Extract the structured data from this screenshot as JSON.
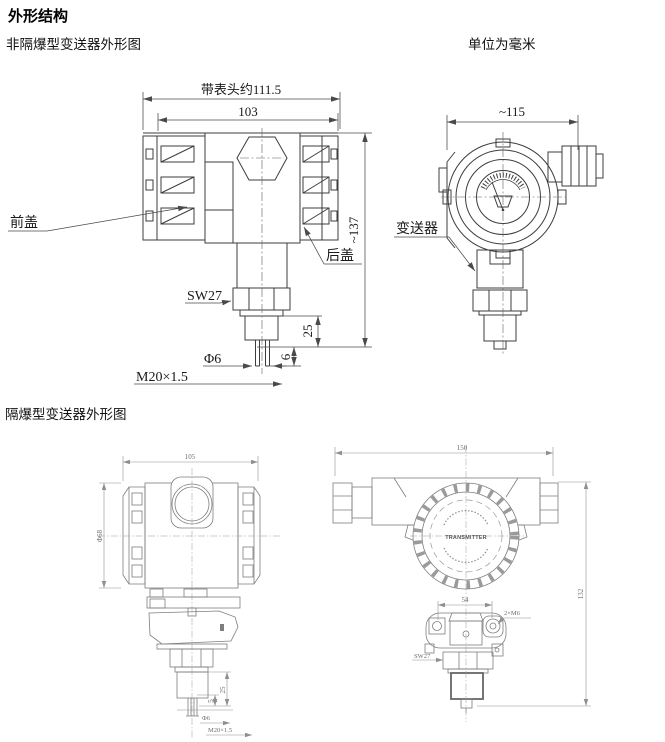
{
  "page": {
    "title": "外形结构",
    "section_non_exproof": "非隔爆型变送器外形图",
    "unit_note": "单位为毫米",
    "section_exproof": "隔爆型变送器外形图"
  },
  "non_exproof_front_view": {
    "dim_width_with_head": "带表头约111.5",
    "dim_width": "103",
    "dim_height": "~137",
    "label_front_cover": "前盖",
    "label_back_cover": "后盖",
    "label_wrench": "SW27",
    "dim_sensor_length": "25",
    "dim_probe_dia": "Φ6",
    "dim_probe_length": "6",
    "dim_thread": "M20×1.5"
  },
  "non_exproof_top_view": {
    "dim_width": "~115",
    "label_transmitter": "变送器"
  },
  "exproof_front_view": {
    "dim_width": "105",
    "dim_body_dia": "Φ68",
    "dim_sensor_length": "25",
    "dim_probe_length": "5",
    "dim_probe_dia": "Φ6",
    "dim_thread": "M20×1.5"
  },
  "exproof_top_view": {
    "dim_width": "150",
    "dim_height": "132",
    "dim_hole_spacing": "54",
    "label_holes": "2×M6",
    "label_wrench": "SW27",
    "label_cover": "TRANSMITTER"
  }
}
